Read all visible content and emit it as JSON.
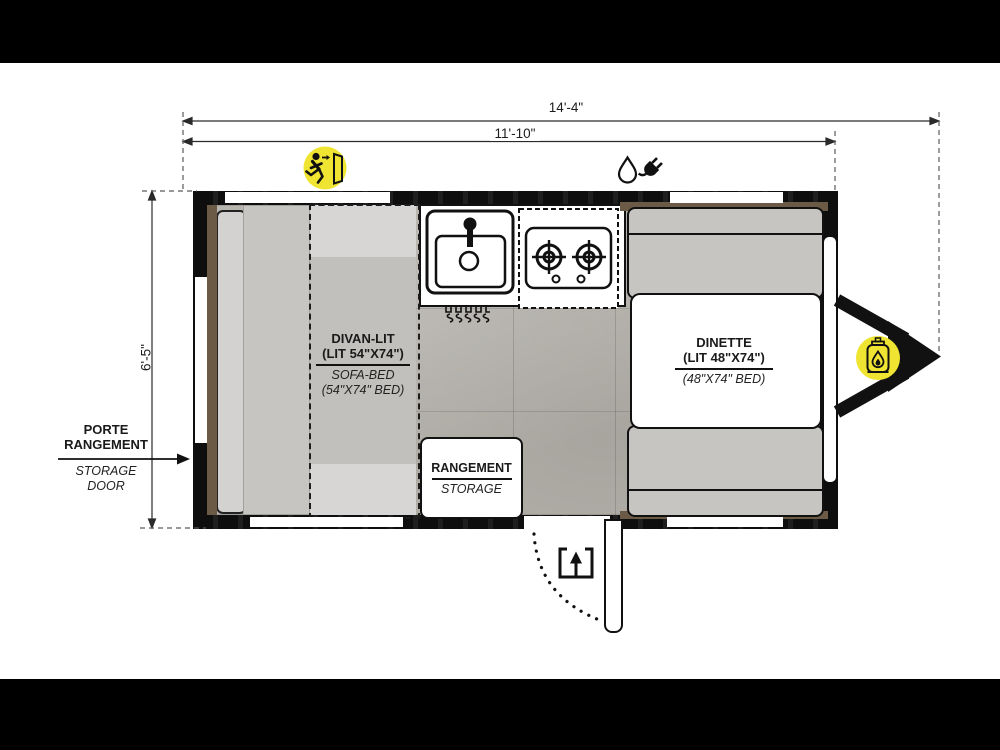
{
  "page": {
    "letterbox_color": "#000000",
    "background": "#ffffff"
  },
  "dimensions": {
    "overall_length": "14'-4\"",
    "interior_length": "11'-10\"",
    "width": "6'-5\""
  },
  "areas": {
    "divan": {
      "title_fr": "DIVAN-LIT",
      "size_fr": "(LIT 54\"X74\")",
      "title_en": "SOFA-BED",
      "size_en": "(54\"X74\" BED)"
    },
    "dinette": {
      "title": "DINETTE",
      "size_fr": "(LIT 48\"X74\")",
      "size_en": "(48\"X74\" BED)"
    },
    "storage": {
      "title_fr": "RANGEMENT",
      "title_en": "STORAGE"
    },
    "storage_door": {
      "fr_line1": "PORTE",
      "fr_line2": "RANGEMENT",
      "en_line1": "STORAGE",
      "en_line2": "DOOR"
    }
  },
  "icons": {
    "exit": "emergency-exit",
    "water": "water-drop",
    "power": "electric-plug",
    "propane": "propane-tank",
    "entry": "entry-arrow",
    "door_swing": "door-swing-arc"
  },
  "colors": {
    "accent_yellow": "#efe431",
    "wall_black": "#111111",
    "wood_brown": "#6b5b46",
    "furniture_gray": "#c6c5c2",
    "floor_gray": "#b7b4ae"
  }
}
